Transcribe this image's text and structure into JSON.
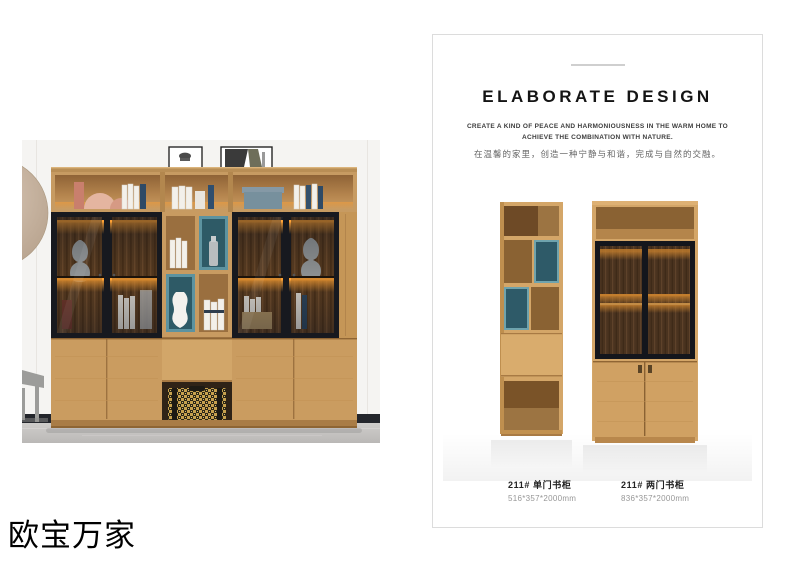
{
  "brand": {
    "name": "欧宝万家"
  },
  "photo": {
    "description": "bookcase combination lifestyle photo",
    "colors": {
      "wood": "#c89b61",
      "wood_interior": "#8a6233",
      "glass_frame": "#16181d",
      "led_glow": "#ffa235",
      "teal_box": "#2e5a66",
      "wall": "#f5f4f2",
      "floor": "#c6c4c2",
      "wall_circle": "#cbb8a6"
    }
  },
  "card": {
    "title": "ELABORATE DESIGN",
    "subtitle_en_line1": "CREATE A KIND OF PEACE AND HARMONIOUSNESS IN THE WARM HOME TO",
    "subtitle_en_line2": "ACHIEVE THE COMBINATION WITH NATURE.",
    "tagline_cn": "在温馨的家里，创造一种宁静与和谐，完成与自然的交融。",
    "products": [
      {
        "model": "211# 单门书柜",
        "dimensions": "516*357*2000mm"
      },
      {
        "model": "211# 两门书柜",
        "dimensions": "836*357*2000mm"
      }
    ]
  }
}
